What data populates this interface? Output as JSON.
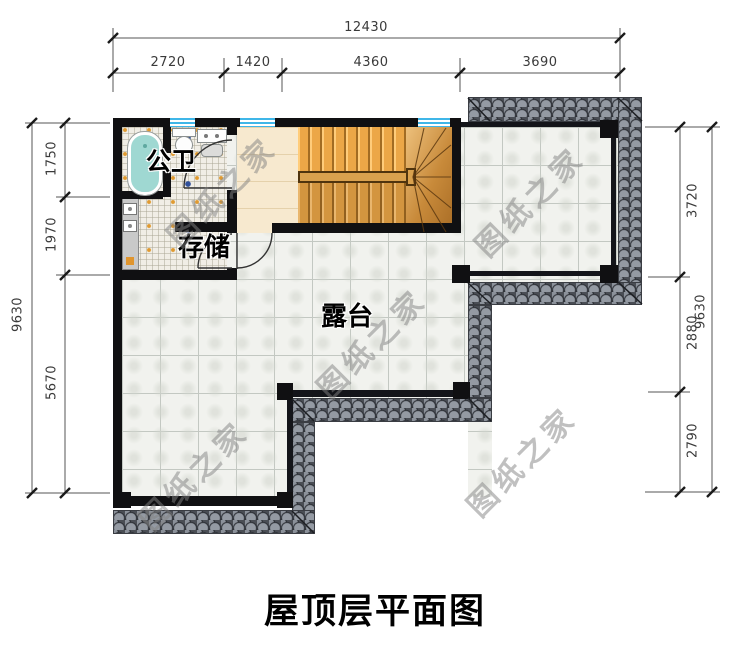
{
  "title": "屋顶层平面图",
  "watermark": {
    "text": "图纸之家"
  },
  "rooms": {
    "bathroom": "公卫",
    "storage": "存储",
    "terrace": "露台"
  },
  "dimensions": {
    "top": {
      "total": "12430",
      "segments": [
        "2720",
        "1420",
        "4360",
        "3690"
      ]
    },
    "left": {
      "total": "9630",
      "segments": [
        "1750",
        "1970",
        "5670"
      ]
    },
    "right": {
      "total": "9630",
      "segments": [
        "3720",
        "2880",
        "2790"
      ]
    }
  },
  "colors": {
    "wall": "#101012",
    "roof_tile": "#949aa3",
    "terrace_tile": "#f1f2ee",
    "window_glass": "#3fb6e8",
    "stair_wood": "#c98c3e",
    "bathtub": "#9fd8d2",
    "dimension_text": "#3a3a3a"
  }
}
